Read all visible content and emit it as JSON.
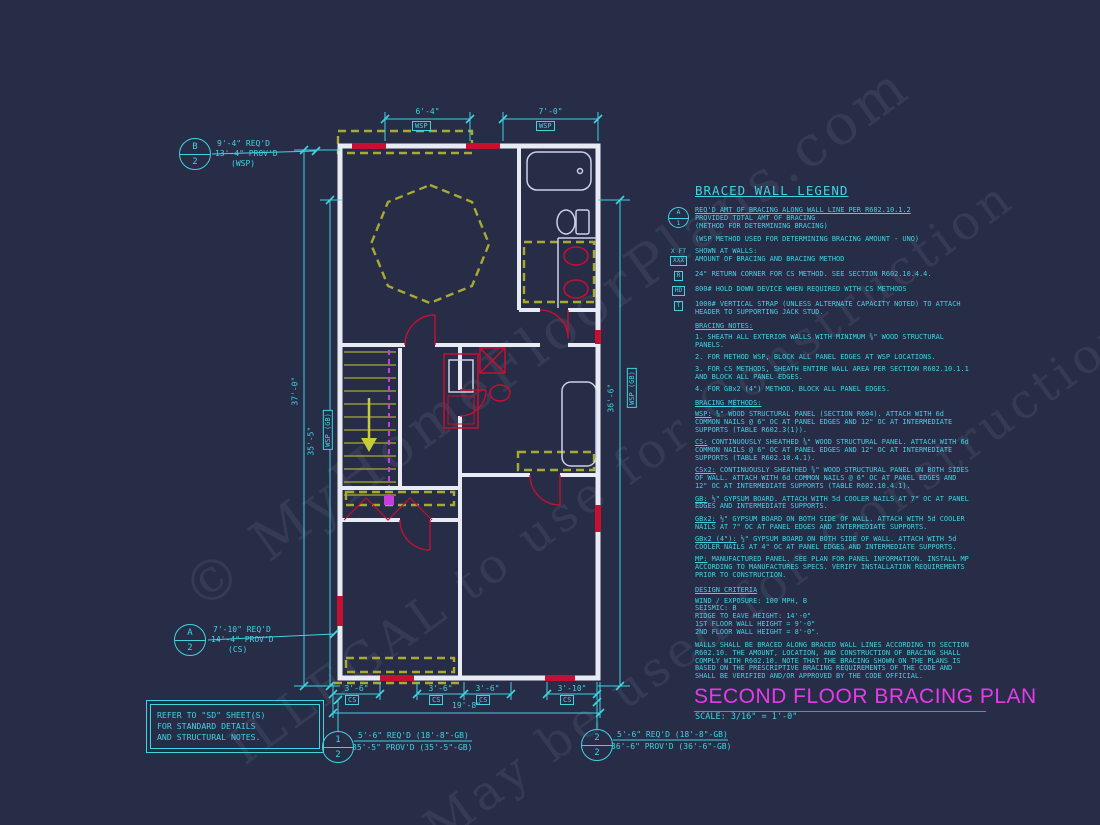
{
  "watermark": {
    "line1": "© MyHomeFloorPlans.com",
    "line2": "ILLEGAL to use for Construction",
    "line3": "May be used for Construction"
  },
  "dims": {
    "top": [
      {
        "v": "6'-4\"",
        "m": "WSP"
      },
      {
        "v": "7'-0\"",
        "m": "WSP"
      }
    ],
    "left_outer": "37'-0\"",
    "left_inner": "35'-5\"",
    "left_inner_method": "WSP (GB)",
    "right": "36'-6\"",
    "right_method": "WSP (GB)",
    "bottom": [
      {
        "v": "3'-6\"",
        "m": "CS"
      },
      {
        "v": "3'-6\"",
        "m": "CS"
      },
      {
        "v": "3'-6\"",
        "m": "CS"
      },
      {
        "v": "3'-10\"",
        "m": "CS"
      }
    ],
    "bottom_total": "19'-8\""
  },
  "markers": {
    "b2": {
      "top": "B",
      "bottom": "2",
      "line1": "9'-4\" REQ'D",
      "line2": "13'-4\" PROV'D",
      "line3": "(WSP)"
    },
    "a2": {
      "top": "A",
      "bottom": "2",
      "line1": "7'-10\" REQ'D",
      "line2": "14'-4\" PROV'D",
      "line3": "(CS)"
    },
    "m1": {
      "top": "1",
      "bottom": "2",
      "line1": "5'-6\" REQ'D (18'-8\"-GB)",
      "line2": "35'-5\" PROV'D (35'-5\"-GB)"
    },
    "m2": {
      "top": "2",
      "bottom": "2",
      "line1": "5'-6\" REQ'D (18'-8\"-GB)",
      "line2": "36'-6\" PROV'D (36'-6\"-GB)"
    }
  },
  "note_box": {
    "line1": "REFER TO \"SD\" SHEET(S)",
    "line2": "FOR STANDARD DETAILS",
    "line3": "AND STRUCTURAL NOTES."
  },
  "legend": {
    "title": "BRACED WALL LEGEND",
    "marker": {
      "top": "A",
      "bottom": "1",
      "line1": "REQ'D AMT OF BRACING ALONG WALL LINE PER R602.10.1.2",
      "line2": "PROVIDED TOTAL AMT OF BRACING",
      "line3": "(METHOD FOR DETERMINING BRACING)"
    },
    "wsp_note": "(WSP METHOD USED FOR DETERMINING BRACING AMOUNT - UNO)",
    "xft": {
      "sym_top": "X FT",
      "sym_bottom": "XXX",
      "text1": "SHOWN AT WALLS:",
      "text2": "AMOUNT OF BRACING AND BRACING METHOD"
    },
    "r": {
      "sym": "R",
      "text": "24\" RETURN CORNER FOR CS METHOD.  SEE SECTION R602.10.4.4."
    },
    "hd": {
      "sym": "HD",
      "text": "800# HOLD DOWN DEVICE WHEN REQUIRED WITH CS METHODS"
    },
    "t": {
      "sym": "T",
      "text": "1000# VERTICAL STRAP (UNLESS ALTERNATE CAPACITY NOTED) TO ATTACH HEADER TO SUPPORTING JACK STUD."
    },
    "notes_title": "BRACING NOTES:",
    "notes": [
      "1. SHEATH ALL EXTERIOR WALLS WITH MINIMUM ⅜\" WOOD STRUCTURAL PANELS.",
      "2. FOR METHOD WSP, BLOCK ALL PANEL EDGES AT WSP LOCATIONS.",
      "3. FOR CS METHODS, SHEATH ENTIRE WALL AREA PER SECTION R602.10.1.1 AND BLOCK ALL PANEL EDGES.",
      "4. FOR GBx2 (4\") METHOD, BLOCK ALL PANEL EDGES."
    ],
    "methods_title": "BRACING METHODS:",
    "methods": [
      {
        "label": "WSP:",
        "text": "⅜\" WOOD STRUCTURAL PANEL (SECTION R604). ATTACH WITH 6d COMMON NAILS @ 6\" OC AT PANEL EDGES AND 12\" OC AT INTERMEDIATE SUPPORTS (TABLE R602.3(1))."
      },
      {
        "label": "CS:",
        "text": "CONTINUOUSLY SHEATHED ⅜\" WOOD STRUCTURAL PANEL. ATTACH WITH 6d COMMON NAILS @ 6\" OC AT PANEL EDGES AND 12\" OC AT INTERMEDIATE SUPPORTS (TABLE R602.10.4.1)."
      },
      {
        "label": "CSx2:",
        "text": "CONTINUOUSLY SHEATHED ⅜\" WOOD STRUCTURAL PANEL ON BOTH SIDES OF WALL. ATTACH WITH 6d COMMON NAILS @ 6\" OC AT PANEL EDGES AND 12\" OC AT INTERMEDIATE SUPPORTS (TABLE R602.10.4.1)."
      },
      {
        "label": "GB:",
        "text": "½\" GYPSUM BOARD. ATTACH WITH 5d COOLER NAILS AT 7\" OC AT PANEL EDGES AND INTERMEDIATE SUPPORTS."
      },
      {
        "label": "GBx2:",
        "text": "½\" GYPSUM BOARD ON BOTH SIDE OF WALL. ATTACH WITH 5d COOLER NAILS AT 7\" OC AT PANEL EDGES AND INTERMEDIATE SUPPORTS."
      },
      {
        "label": "GBx2 (4\"):",
        "text": "½\" GYPSUM BOARD ON BOTH SIDE OF WALL. ATTACH WITH 5d COOLER NAILS AT 4\" OC AT PANEL EDGES AND INTERMEDIATE SUPPORTS."
      },
      {
        "label": "MP:",
        "text": "MANUFACTURED PANEL. SEE PLAN FOR PANEL INFORMATION. INSTALL MP ACCORDING TO MANUFACTURES SPECS. VERIFY INSTALLATION REQUIREMENTS PRIOR TO CONSTRUCTION."
      }
    ],
    "criteria_title": "DESIGN CRITERIA",
    "criteria": [
      "WIND / EXPOSURE:  100 MPH, B",
      "SEISMIC:  B",
      "RIDGE TO EAVE HEIGHT: 14'-0\"",
      "1ST FLOOR WALL HEIGHT = 9'-0\"",
      "2ND FLOOR WALL HEIGHT = 8'-0\"."
    ],
    "closing": "WALLS SHALL BE BRACED ALONG BRACED WALL LINES ACCORDING TO SECTION R602.10. THE AMOUNT, LOCATION, AND CONSTRUCTION OF BRACING SHALL COMPLY WITH R602.10. NOTE THAT THE BRACING SHOWN ON THE PLANS IS BASED ON THE PRESCRIPTIVE BRACING REQUIREMENTS OF THE CODE AND SHALL BE VERIFIED AND/OR APPROVED BY THE CODE OFFICIAL."
  },
  "title_block": {
    "title": "SECOND FLOOR BRACING PLAN",
    "scale": "SCALE: 3/16\" = 1'-0\""
  },
  "colors": {
    "background": "#272c47",
    "cyan": "#3fd4e2",
    "magenta": "#e93ae9",
    "wall_white": "#e9ebf4",
    "bracing_red": "#c51031",
    "panel_olive": "#a8aa32",
    "rail_magenta": "#c83ce0"
  }
}
